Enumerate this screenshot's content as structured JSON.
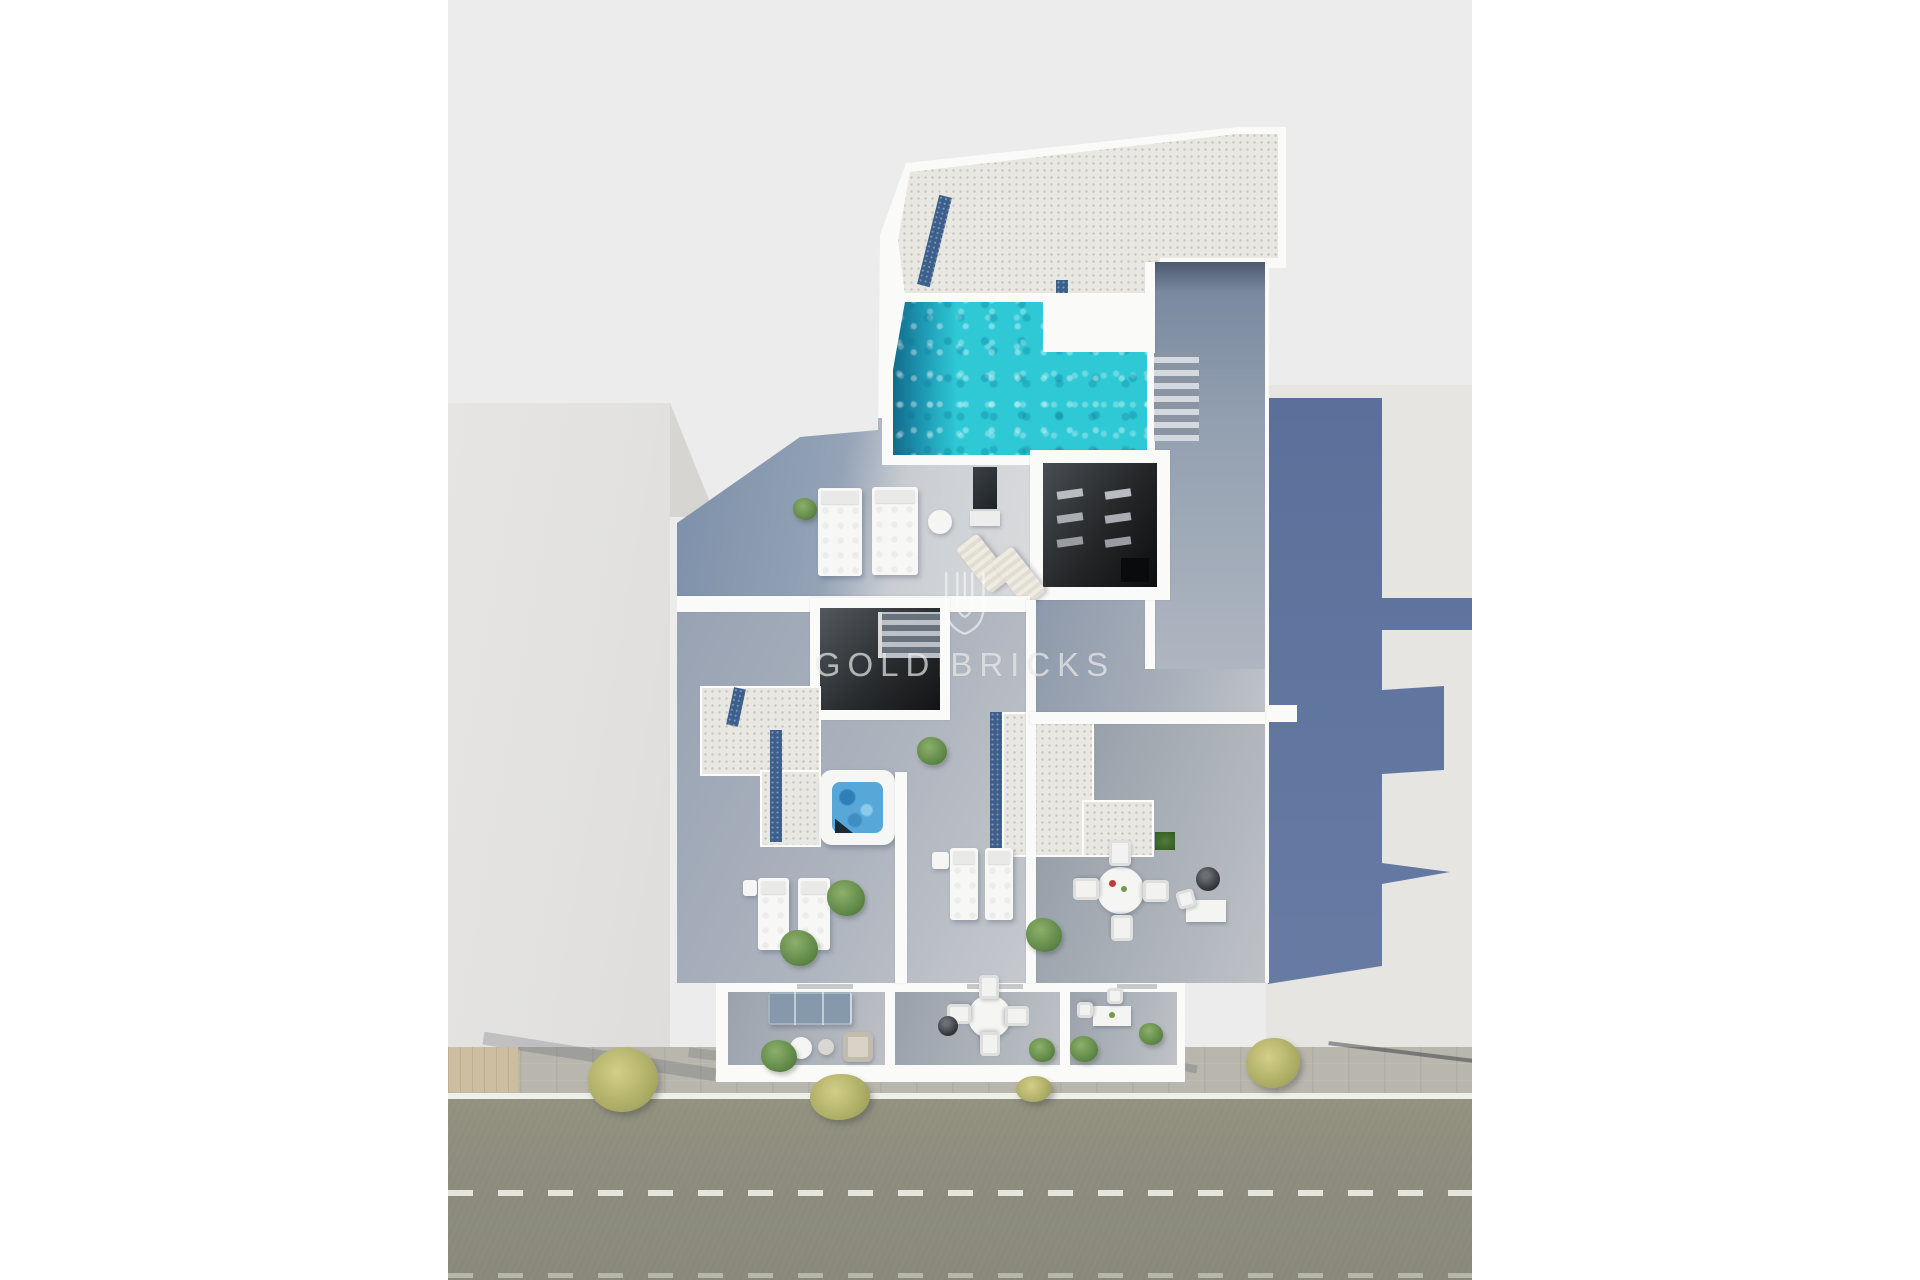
{
  "watermark": {
    "brand_first": "GOLD",
    "brand_second": "BRICKS"
  },
  "palette": {
    "page_background": "#FFFFFF",
    "render_background": "#ECECEC",
    "neighbor_roof": "#E4E3E1",
    "building_wall": "#FAFAF8",
    "roof_gravel": "#E9E7E1",
    "pebble_border": "#3D5F8C",
    "pool_water": "#2FC9D6",
    "pool_deep_end": "#0E6E95",
    "wood_floor": "#8E9DB2",
    "cast_shadow": "#5F759D",
    "jacuzzi_water": "#57A8D8",
    "sidewalk": "#B8B6AD",
    "road": "#8F8E80",
    "road_marking": "#EDEDE3",
    "tree_foliage": "#AEAE66"
  }
}
